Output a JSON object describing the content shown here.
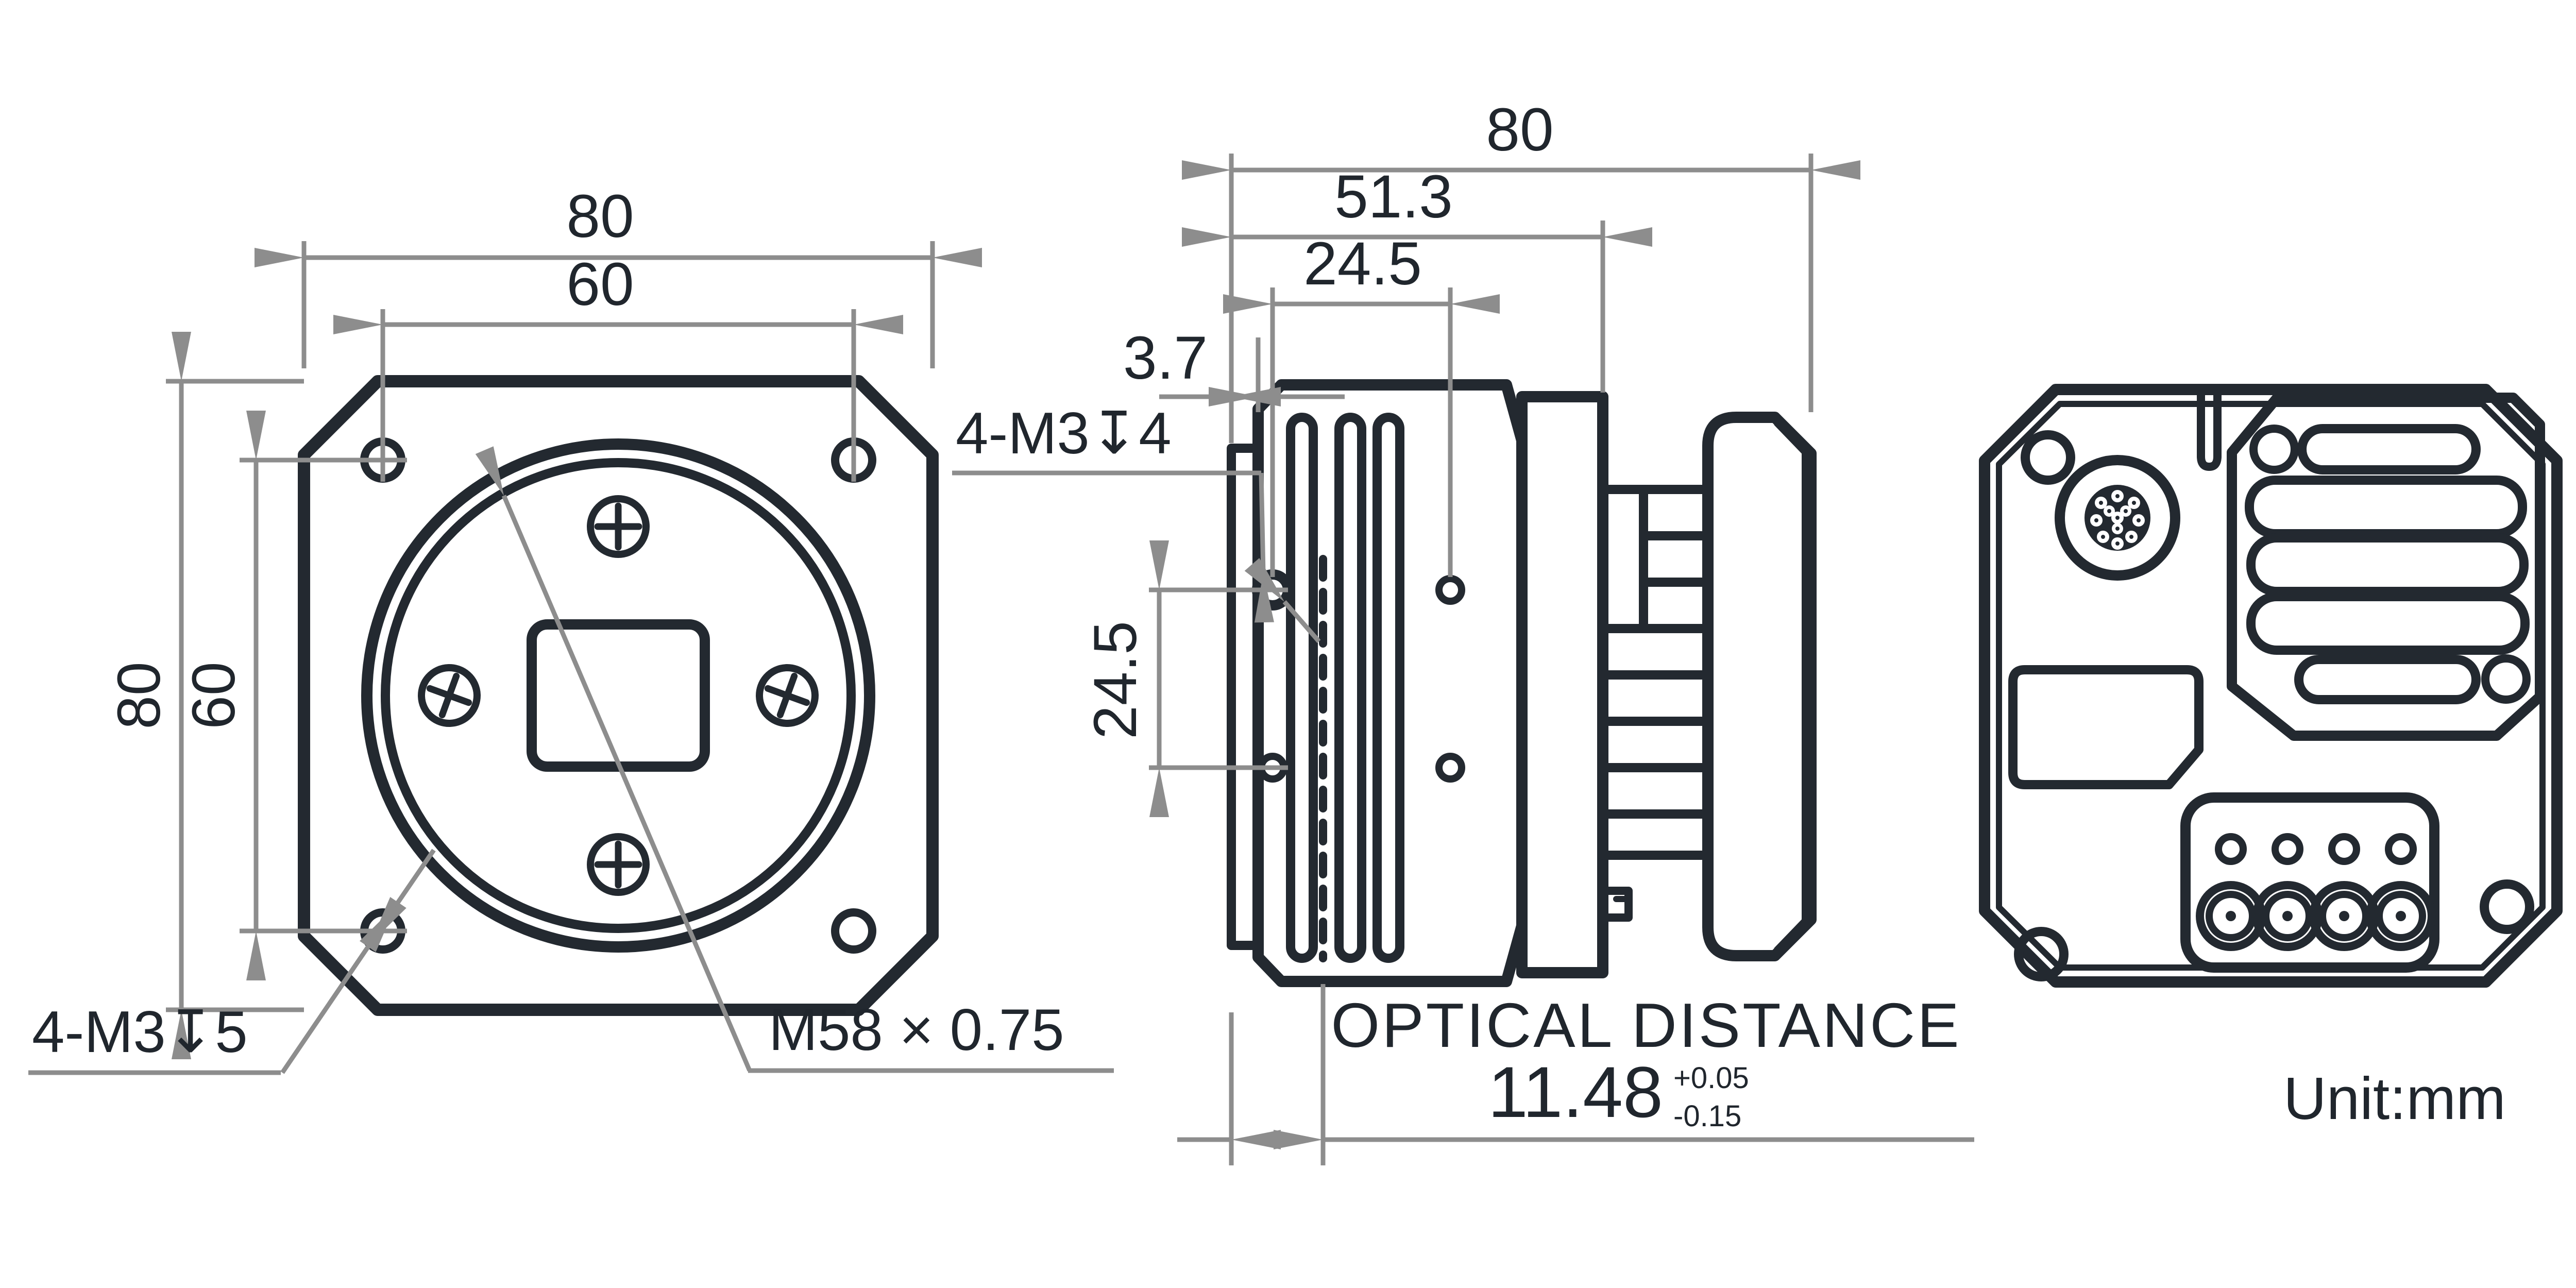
{
  "meta": {
    "unit_label": "Unit:mm",
    "line_color": "#232930",
    "dim_line_color": "#8d8d8d",
    "text_color": "#20262d"
  },
  "front_view": {
    "dims": {
      "outer_width": "80",
      "hole_span_width": "60",
      "outer_height": "80",
      "hole_span_height": "60"
    },
    "notes": {
      "corner_holes": "4-M3↧5",
      "lens_mount": "M58 × 0.75"
    }
  },
  "side_view": {
    "dims": {
      "total_depth": "80",
      "body_depth": "51.3",
      "flange_thickness": "3.7",
      "hole_offset": "24.5",
      "hole_spacing": "24.5"
    },
    "notes": {
      "side_holes": "4-M3↧4"
    },
    "optical": {
      "label": "OPTICAL DISTANCE",
      "value": "11.48",
      "tol_plus": "+0.05",
      "tol_minus": "-0.15"
    }
  },
  "rear_view": {}
}
